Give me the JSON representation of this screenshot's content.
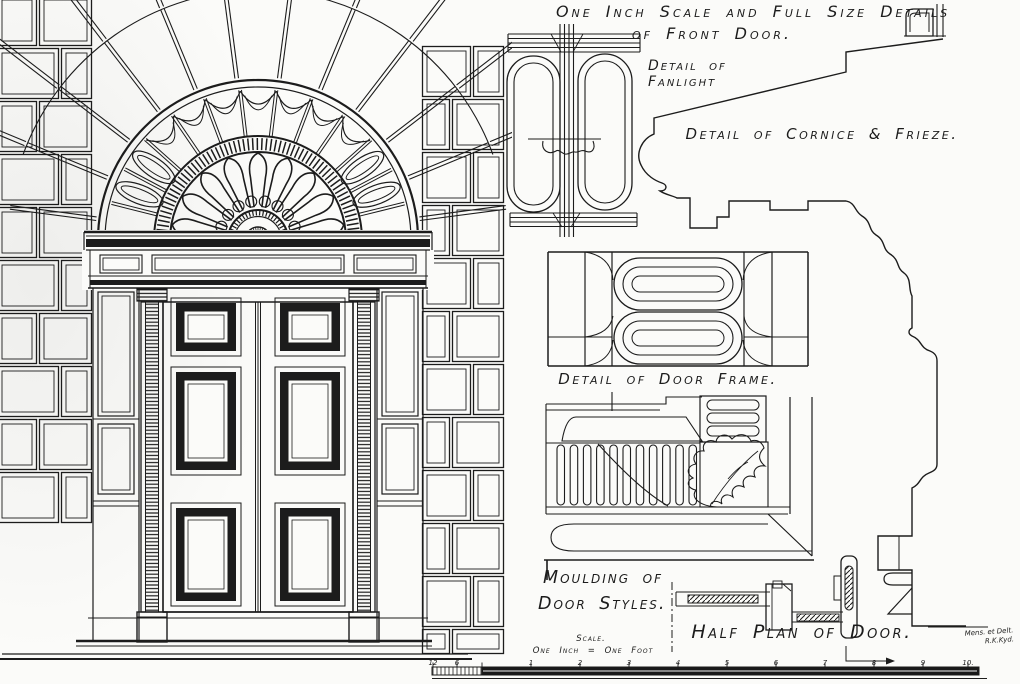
{
  "sheet": {
    "title_line1": "One Inch Scale and Full Size Details",
    "title_line2": "of Front Door.",
    "labels": {
      "detail_of_fanlight_line1": "Detail of",
      "detail_of_fanlight_line2": "Fanlight",
      "detail_of_cornice_frieze": "Detail of Cornice & Frieze.",
      "detail_of_door_frame": "Detail of Door Frame.",
      "moulding_of_line1": "Moulding of",
      "moulding_of_line2": "Door Styles.",
      "scale_caption_line1": "Scale.",
      "scale_caption_line2": "One Inch = One Foot",
      "half_plan_of_door": "Half Plan of Door."
    },
    "signature": {
      "line1": "Mens. et Delt.",
      "line2": "R.K.Kyd."
    },
    "scale_bar": {
      "tick_labels": [
        "12",
        "6",
        "1",
        "2",
        "3",
        "4",
        "5",
        "6",
        "7",
        "8",
        "9",
        "10."
      ]
    },
    "colors": {
      "ink": "#1c1c1c",
      "paper": "#fbfbf9"
    }
  }
}
